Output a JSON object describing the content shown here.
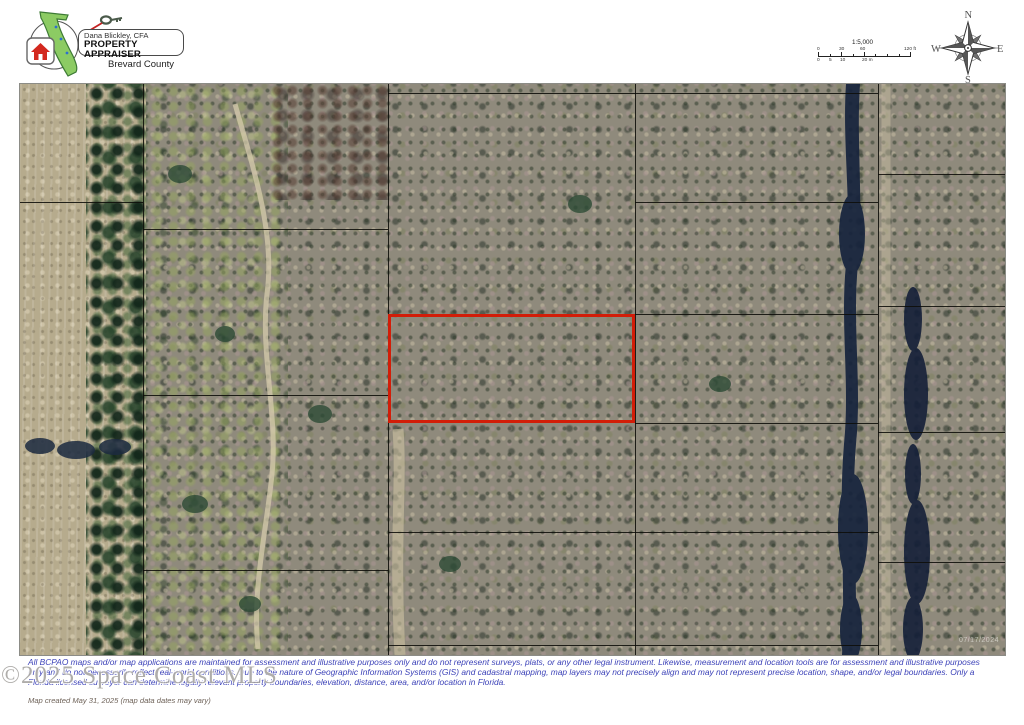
{
  "header": {
    "logo": {
      "name_line": "Dana Blickley, CFA",
      "title_line": "PROPERTY APPRAISER",
      "county_line": "Brevard County"
    },
    "scale": {
      "ratio": "1:5,000",
      "ft_labels": [
        "0",
        "30",
        "60",
        "120 ft"
      ],
      "m_labels": [
        "0",
        "5",
        "10",
        "20 m"
      ]
    },
    "compass": {
      "n": "N",
      "s": "S",
      "e": "E",
      "w": "W"
    }
  },
  "map": {
    "imagery_date_watermark": "07/17/2024",
    "colors": {
      "subject_parcel_outline": "#d21d08",
      "parcel_boundary_line": "#0e0e09",
      "water_feature": "#16233c",
      "field": "#b6ab8d"
    }
  },
  "footer": {
    "disclaimer_lines": [
      "All BCPAO maps and/or map applications are maintained for assessment and illustrative purposes only and do not represent surveys, plats, or any other legal instrument. Likewise, measurement and location tools are for assessment and illustrative purposes",
      "only and do not necessarily reflect real-world conditions. Due to the nature of Geographic Information Systems (GIS) and cadastral mapping, map layers may not precisely align and may not represent precise location, shape, and/or legal boundaries. Only a",
      "Florida licensed surveyor can determine legally relevant property boundaries, elevation, distance, area, and/or location in Florida."
    ],
    "mls_watermark": "©2025 Space Coast MLS",
    "created_note": "Map created May 31, 2025 (map data dates may vary)"
  }
}
